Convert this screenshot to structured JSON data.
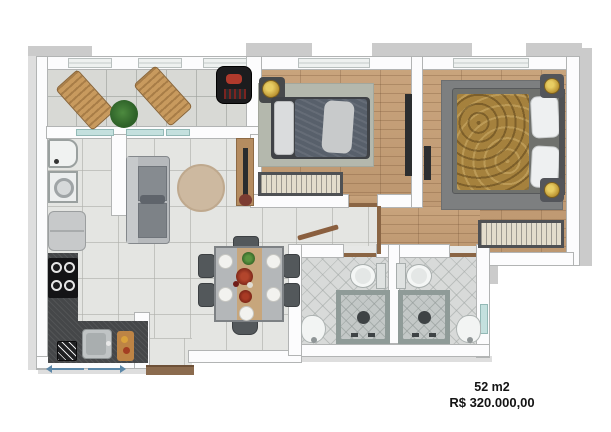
{
  "image": {
    "type": "real-estate-floor-plan",
    "view": "top-down-3d-render"
  },
  "footer": {
    "area_label": "52 m2",
    "price_label": "R$ 320.000,00"
  },
  "rooms": [
    "balcony",
    "bedroom-1",
    "bedroom-2",
    "living-room",
    "dining-area",
    "kitchen",
    "laundry-area",
    "hallway",
    "bathroom-1",
    "bathroom-2",
    "entry"
  ],
  "palette": {
    "background": "#ffffff",
    "wall": "#fcfcfd",
    "wall_shadow": "#cbcbcb",
    "tile_floor": "#e4e5e2",
    "balcony_tile": "#d8d9d5",
    "wood_floor": "#c39d76",
    "bath_tile": "#d8dad9",
    "counter_granite": "#454749",
    "sofa_gray": "#b6b9bc",
    "duvet_slate": "#58606b",
    "duvet_gold": "#a5813d",
    "accent_gold": "#c8a33b",
    "glass_teal": "#c4e0de",
    "entry_mat_brown": "#8b6b4e",
    "dimension_line_blue": "#5b87a8",
    "text": "#141414"
  }
}
